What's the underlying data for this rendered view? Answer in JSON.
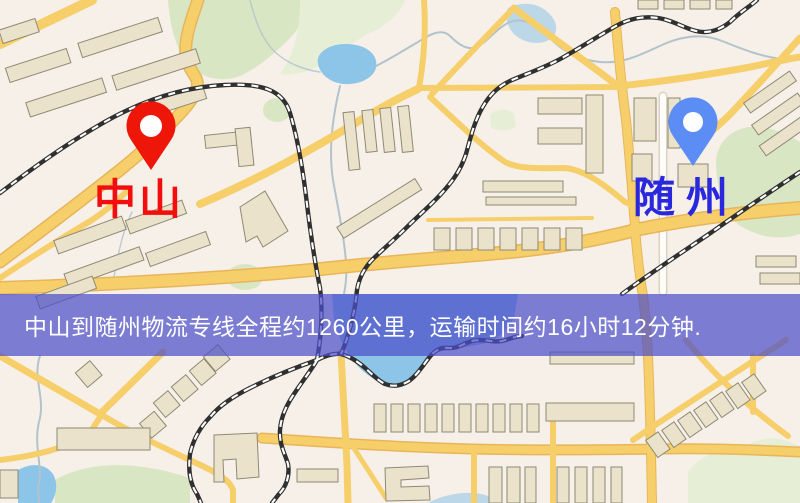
{
  "banner": {
    "text": "中山到随州物流专线全程约1260公里，运输时间约16小时12分钟."
  },
  "markers": {
    "origin": {
      "label": "中山",
      "pin_color": "#ee1609",
      "label_color": "#f30d0d"
    },
    "destination": {
      "label": "随州",
      "pin_color": "#5c8df4",
      "label_color": "#2a28dc"
    }
  },
  "colors": {
    "map_bg": "#f6f0e9",
    "road_fill": "#f6cf6a",
    "road_casing": "#e8b55b",
    "building_fill": "#eae2ca",
    "building_outline": "#8f8974",
    "park": "#d9e6c4",
    "park_pale": "#e6eed6",
    "water": "#8cc5e8",
    "stream": "#b2c3cc",
    "railway_dark": "#303030",
    "railway_light": "#ffffff",
    "white_road": "#fdfcf8",
    "white_road_casing": "#d9d3c5",
    "banner_bg": "rgba(76,79,201,0.72)",
    "banner_text": "#ffffff"
  }
}
